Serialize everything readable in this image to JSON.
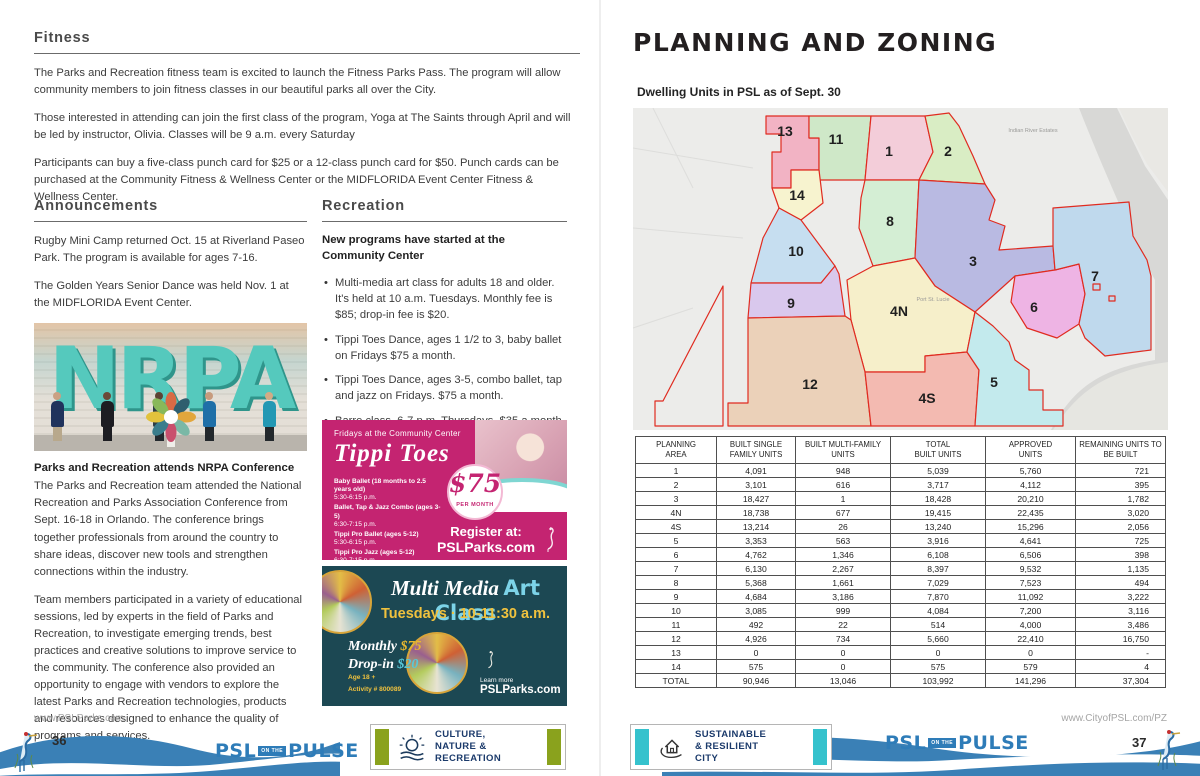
{
  "left_page": {
    "fitness": {
      "title": "Fitness",
      "paragraphs": [
        "The Parks and Recreation fitness team is excited to launch the Fitness Parks Pass. The program will allow community members to join fitness classes in our beautiful parks all over the City.",
        "Those interested in attending can join the first class of the program, Yoga at The Saints through April and will be led by instructor, Olivia. Classes will be 9 a.m. every Saturday",
        "Participants can buy a five-class punch card for $25 or a 12-class punch card for $50. Punch cards can be purchased at the Community Fitness & Wellness Center or the MIDFLORIDA Event Center Fitness & Wellness Center."
      ]
    },
    "announcements": {
      "title": "Announcements",
      "paragraphs": [
        "Rugby Mini Camp returned Oct. 15 at Riverland Paseo Park. The program is available for ages 7-16.",
        "The Golden Years Senior Dance was held Nov. 1 at the MIDFLORIDA Event Center."
      ],
      "photo_letters": "NRPA",
      "caption_title": "Parks and Recreation attends NRPA Conference",
      "caption_paragraphs": [
        "The Parks and Recreation team attended the National Recreation and Parks Association Conference from Sept. 16-18 in Orlando. The conference brings together professionals from around the country to share ideas, discover new tools and strengthen connections within the industry.",
        "Team members participated in a variety of educational sessions, led by experts in the field of Parks and Recreation, to investigate emerging trends, best practices and creative solutions to improve service to the community. The conference also provided an opportunity to engage with vendors to explore the latest Parks and Recreation technologies, products and resources designed to enhance the quality of programs and services."
      ]
    },
    "recreation": {
      "title": "Recreation",
      "intro": "New programs have started at the Community Center",
      "bullets": [
        "Multi-media art class for adults 18 and older. It's held at 10 a.m. Tuesdays. Monthly fee is $85; drop-in fee is $20.",
        "Tippi Toes Dance, ages 1 1/2 to 3, baby ballet on Fridays $75 a month.",
        "Tippi Toes Dance, ages 3-5, combo ballet, tap and jazz on Fridays. $75 a month.",
        "Barre class, 6-7 p.m. Thursdays. $35 a month."
      ]
    },
    "tippi_ad": {
      "header": "Fridays at the Community Center",
      "logo": "Tippi Toes",
      "schedule": [
        {
          "name": "Baby Ballet (18 months to 2.5 years old)",
          "time": "5:30-6:15 p.m."
        },
        {
          "name": "Ballet, Tap & Jazz Combo (ages 3-5)",
          "time": "6:30-7:15 p.m."
        },
        {
          "name": "Tippi Pro Ballet (ages 5-12)",
          "time": "5:30-6:15 p.m."
        },
        {
          "name": "Tippi Pro Jazz (ages 5-12)",
          "time": "6:30-7:15 p.m."
        }
      ],
      "price": "$75",
      "price_unit": "PER MONTH",
      "register_line1": "Register at:",
      "register_line2": "PSLParks.com",
      "bg_color": "#c42471"
    },
    "mm_ad": {
      "title_script": "Multi Media",
      "title_accent": "Art Class",
      "when": "Tuesdays  ·  10-11:30 a.m.",
      "monthly_label": "Monthly",
      "monthly_price": "$75",
      "dropin_label": "Drop-in",
      "dropin_price": "$20",
      "age": "Age 18 +",
      "activity": "Activity # 800089",
      "learn_more": "Learn more",
      "url": "PSLParks.com",
      "bg_color": "#1c4853"
    },
    "footer": {
      "url": "www.PSLParks.com",
      "page_number": "36",
      "logo": {
        "psl": "PSL",
        "onthe": "ON THE",
        "pulse": "PULSE"
      },
      "badge_lines": "CULTURE,\nNATURE &\nRECREATION"
    }
  },
  "right_page": {
    "title": "PLANNING AND ZONING",
    "map": {
      "subtitle": "Dwelling Units in PSL as of Sept. 30",
      "boundary_color": "#e02b20",
      "labels": [
        {
          "id": "13",
          "x": 152,
          "y": 28
        },
        {
          "id": "11",
          "x": 203,
          "y": 36
        },
        {
          "id": "1",
          "x": 256,
          "y": 48
        },
        {
          "id": "2",
          "x": 315,
          "y": 48
        },
        {
          "id": "14",
          "x": 164,
          "y": 92
        },
        {
          "id": "8",
          "x": 257,
          "y": 118
        },
        {
          "id": "10",
          "x": 163,
          "y": 148
        },
        {
          "id": "3",
          "x": 340,
          "y": 158
        },
        {
          "id": "9",
          "x": 158,
          "y": 200
        },
        {
          "id": "4N",
          "x": 266,
          "y": 208
        },
        {
          "id": "6",
          "x": 401,
          "y": 204
        },
        {
          "id": "7",
          "x": 462,
          "y": 173
        },
        {
          "id": "12",
          "x": 177,
          "y": 281
        },
        {
          "id": "4S",
          "x": 294,
          "y": 295
        },
        {
          "id": "5",
          "x": 361,
          "y": 279
        }
      ],
      "region_colors": {
        "13": "#f2b3c4",
        "11": "#cfe8c8",
        "1": "#f3cdd9",
        "2": "#d9edc4",
        "14": "#f7f3cf",
        "8": "#d4eed4",
        "10": "#c6def0",
        "3": "#b9bae2",
        "9": "#d9c8ed",
        "4N": "#f6efca",
        "6": "#eeb4e4",
        "7": "#bfd9ed",
        "12": "#ebd1b9",
        "4S": "#f3bab1",
        "5": "#c3eaed"
      },
      "small_labels": [
        {
          "text": "Port St. Lucie",
          "x": 300,
          "y": 193
        },
        {
          "text": "Indian River Estates",
          "x": 400,
          "y": 24
        }
      ]
    },
    "table": {
      "columns": [
        "PLANNING\nAREA",
        "BUILT SINGLE\nFAMILY UNITS",
        "BUILT MULTI-FAMILY\nUNITS",
        "TOTAL\nBUILT UNITS",
        "APPROVED\nUNITS",
        "REMAINING UNITS TO\nBE BUILT"
      ],
      "rows": [
        [
          "1",
          "4,091",
          "948",
          "5,039",
          "5,760",
          "721"
        ],
        [
          "2",
          "3,101",
          "616",
          "3,717",
          "4,112",
          "395"
        ],
        [
          "3",
          "18,427",
          "1",
          "18,428",
          "20,210",
          "1,782"
        ],
        [
          "4N",
          "18,738",
          "677",
          "19,415",
          "22,435",
          "3,020"
        ],
        [
          "4S",
          "13,214",
          "26",
          "13,240",
          "15,296",
          "2,056"
        ],
        [
          "5",
          "3,353",
          "563",
          "3,916",
          "4,641",
          "725"
        ],
        [
          "6",
          "4,762",
          "1,346",
          "6,108",
          "6,506",
          "398"
        ],
        [
          "7",
          "6,130",
          "2,267",
          "8,397",
          "9,532",
          "1,135"
        ],
        [
          "8",
          "5,368",
          "1,661",
          "7,029",
          "7,523",
          "494"
        ],
        [
          "9",
          "4,684",
          "3,186",
          "7,870",
          "11,092",
          "3,222"
        ],
        [
          "10",
          "3,085",
          "999",
          "4,084",
          "7,200",
          "3,116"
        ],
        [
          "11",
          "492",
          "22",
          "514",
          "4,000",
          "3,486"
        ],
        [
          "12",
          "4,926",
          "734",
          "5,660",
          "22,410",
          "16,750"
        ],
        [
          "13",
          "0",
          "0",
          "0",
          "0",
          "-"
        ],
        [
          "14",
          "575",
          "0",
          "575",
          "579",
          "4"
        ],
        [
          "TOTAL",
          "90,946",
          "13,046",
          "103,992",
          "141,296",
          "37,304"
        ]
      ]
    },
    "footer": {
      "url": "www.CityofPSL.com/PZ",
      "page_number": "37",
      "logo": {
        "psl": "PSL",
        "onthe": "ON THE",
        "pulse": "PULSE"
      },
      "badge_lines": "SUSTAINABLE\n& RESILIENT\nCITY"
    }
  },
  "colors": {
    "wave_blue": "#3a80b6",
    "logo_blue": "#2e7cb8",
    "badge_green": "#8aa21d",
    "badge_teal": "#35c2cd",
    "badge_text_navy": "#1b3a6b"
  }
}
